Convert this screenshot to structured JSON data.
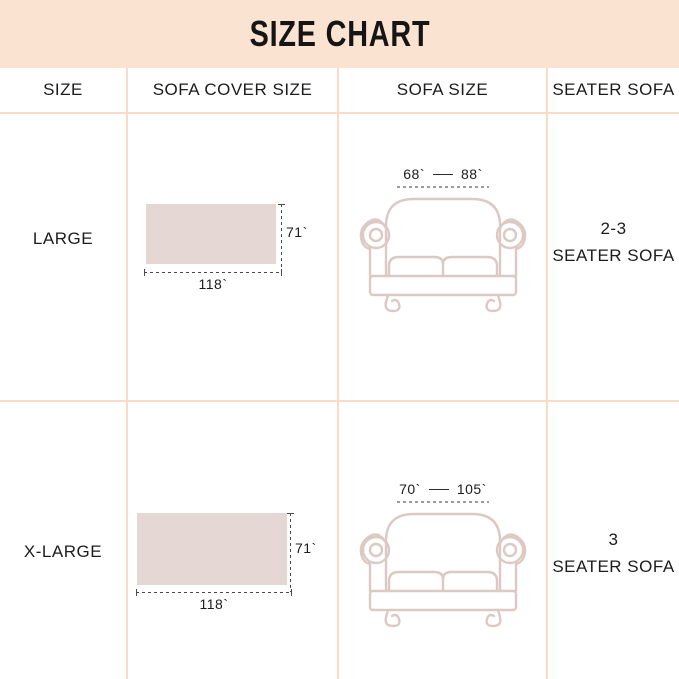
{
  "title": "SIZE CHART",
  "columns": [
    "SIZE",
    "SOFA COVER SIZE",
    "SOFA SIZE",
    "SEATER SOFA"
  ],
  "rows": [
    {
      "size": "LARGE",
      "cover": {
        "width_label": "118`",
        "height_label": "71`"
      },
      "sofa": {
        "min_label": "68`",
        "max_label": "88`"
      },
      "seater": {
        "line1": "2-3",
        "line2": "SEATER SOFA"
      }
    },
    {
      "size": "X-LARGE",
      "cover": {
        "width_label": "118`",
        "height_label": "71`"
      },
      "sofa": {
        "min_label": "70`",
        "max_label": "105`"
      },
      "seater": {
        "line1": "3",
        "line2": "SEATER SOFA"
      }
    }
  ],
  "colors": {
    "band_bg": "#fbe3d2",
    "border": "#f8dcc7",
    "cover_fill": "#e5d8d4",
    "sofa_outline": "#dcc9c4",
    "measure_line": "#4a4a4a"
  }
}
